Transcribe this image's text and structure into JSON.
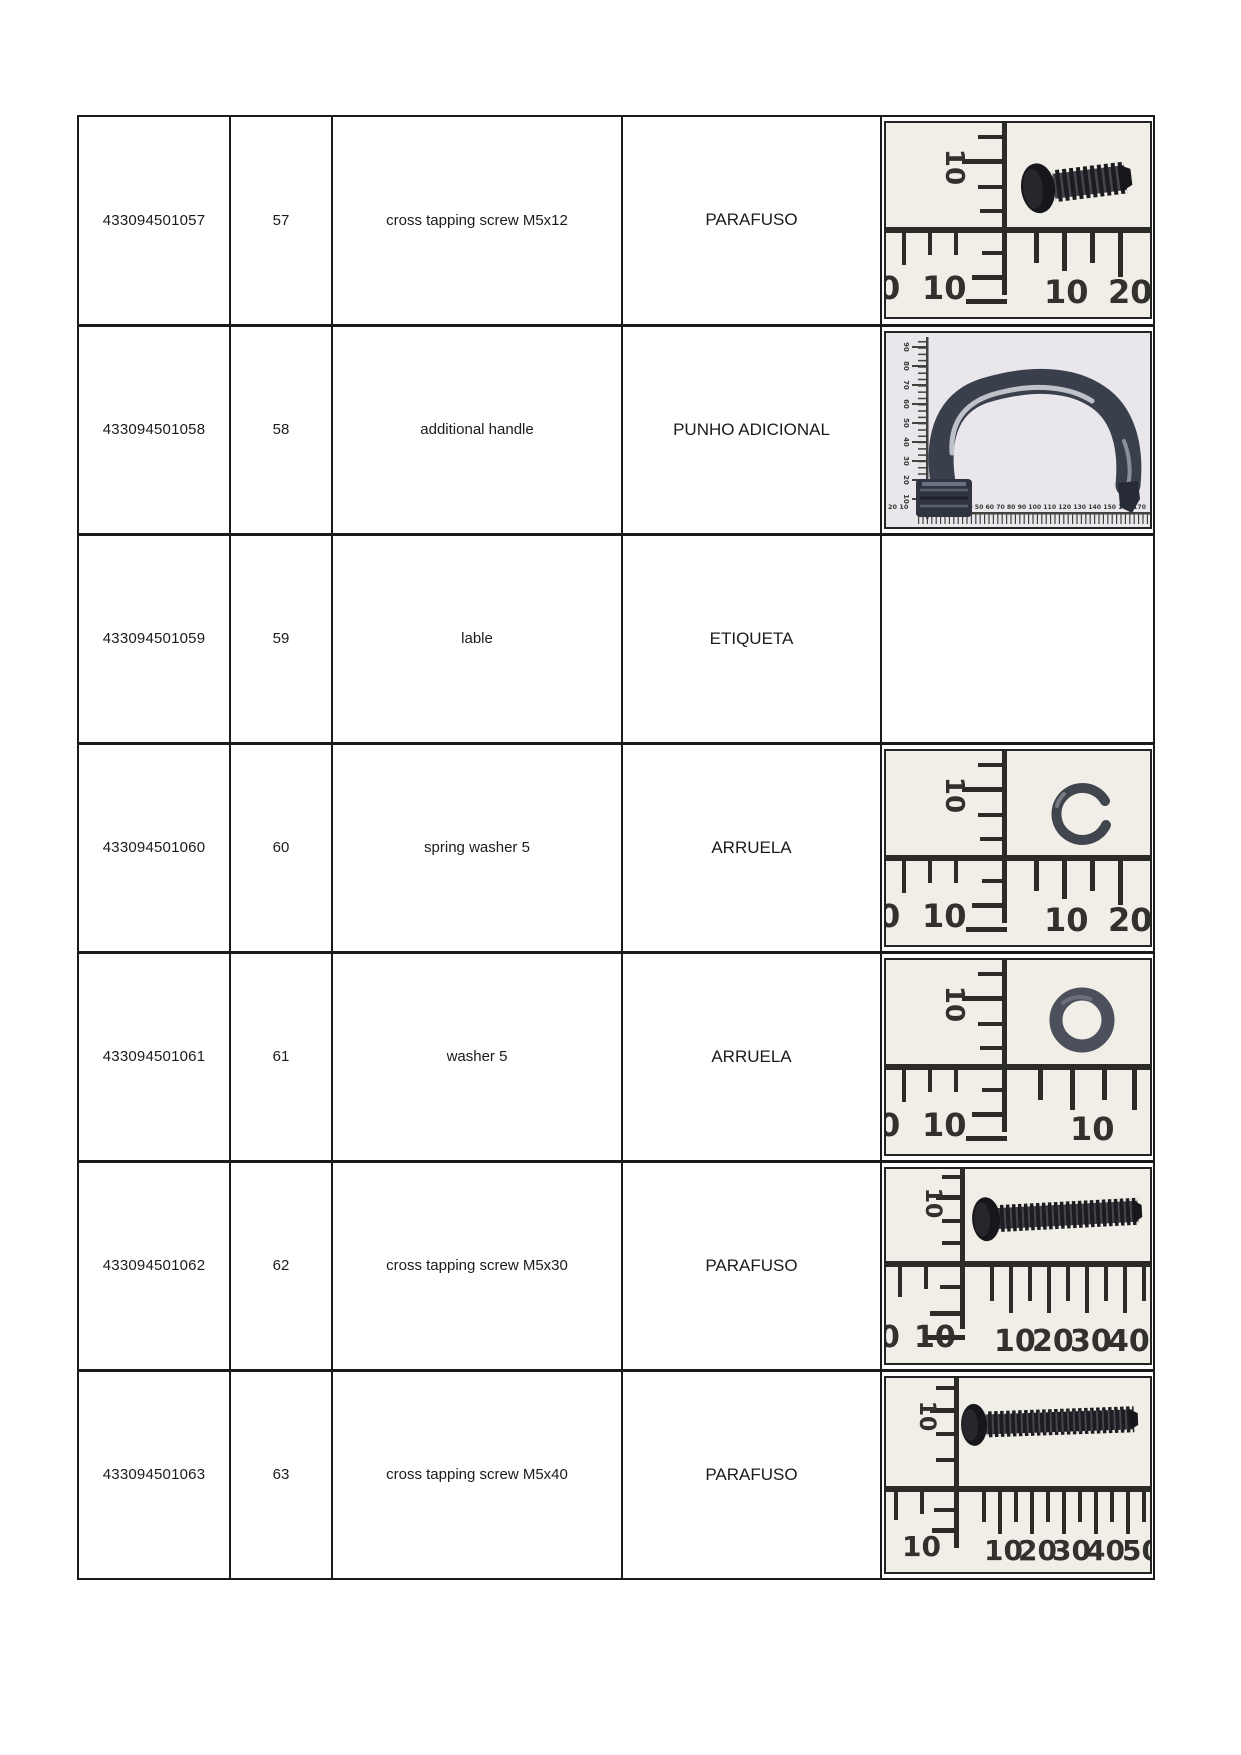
{
  "table": {
    "rows": [
      {
        "code": "433094501057",
        "no": "57",
        "desc_en": "cross tapping screw M5x12",
        "desc_pt": "PARAFUSO",
        "photo": {
          "part": "cross tapping screw M5x12 on ruler",
          "v_label": "10",
          "bl_0": "0",
          "bl_10": "10",
          "br_1": "10",
          "br_2": "20"
        }
      },
      {
        "code": "433094501058",
        "no": "58",
        "desc_en": "additional handle",
        "desc_pt": "PUNHO ADICIONAL",
        "photo": {
          "part": "additional handle on ruler",
          "side_labels": [
            "90",
            "80",
            "70",
            "60",
            "50",
            "40",
            "30",
            "20",
            "10"
          ],
          "strip_prefix": "20 10",
          "strip_numbers": "10 20 30 40 50 60 70 80 90 100 110 120 130 140 150 160 170"
        }
      },
      {
        "code": "433094501059",
        "no": "59",
        "desc_en": "lable",
        "desc_pt": "ETIQUETA",
        "photo": null
      },
      {
        "code": "433094501060",
        "no": "60",
        "desc_en": "spring washer 5",
        "desc_pt": "ARRUELA",
        "photo": {
          "part": "spring washer 5 on ruler",
          "v_label": "10",
          "bl_0": "0",
          "bl_10": "10",
          "br_1": "10",
          "br_2": "20"
        }
      },
      {
        "code": "433094501061",
        "no": "61",
        "desc_en": "washer 5",
        "desc_pt": "ARRUELA",
        "photo": {
          "part": "washer 5 on ruler",
          "v_label": "10",
          "bl_0": "0",
          "bl_10": "10",
          "br_1": "10"
        }
      },
      {
        "code": "433094501062",
        "no": "62",
        "desc_en": "cross tapping screw M5x30",
        "desc_pt": "PARAFUSO",
        "photo": {
          "part": "cross tapping screw M5x30 on ruler",
          "v_label": "10",
          "bl_0": "0",
          "bl_10": "10",
          "br_1": "10",
          "br_2": "20",
          "br_3": "30",
          "br_4": "40"
        }
      },
      {
        "code": "433094501063",
        "no": "63",
        "desc_en": "cross tapping screw M5x40",
        "desc_pt": "PARAFUSO",
        "photo": {
          "part": "cross tapping screw M5x40 on ruler",
          "v_label": "10",
          "bl_10": "10",
          "br_1": "10",
          "br_2": "20",
          "br_3": "30",
          "br_4": "40",
          "br_5": "50"
        }
      }
    ]
  },
  "colors": {
    "border": "#1a1a1a",
    "text": "#1b1b1b",
    "photo_background": "#f0eee6",
    "handle_photo_background": "#e9e7ec",
    "ruler_marks": "#2d2b28",
    "part_dark": "#1d1d22"
  }
}
